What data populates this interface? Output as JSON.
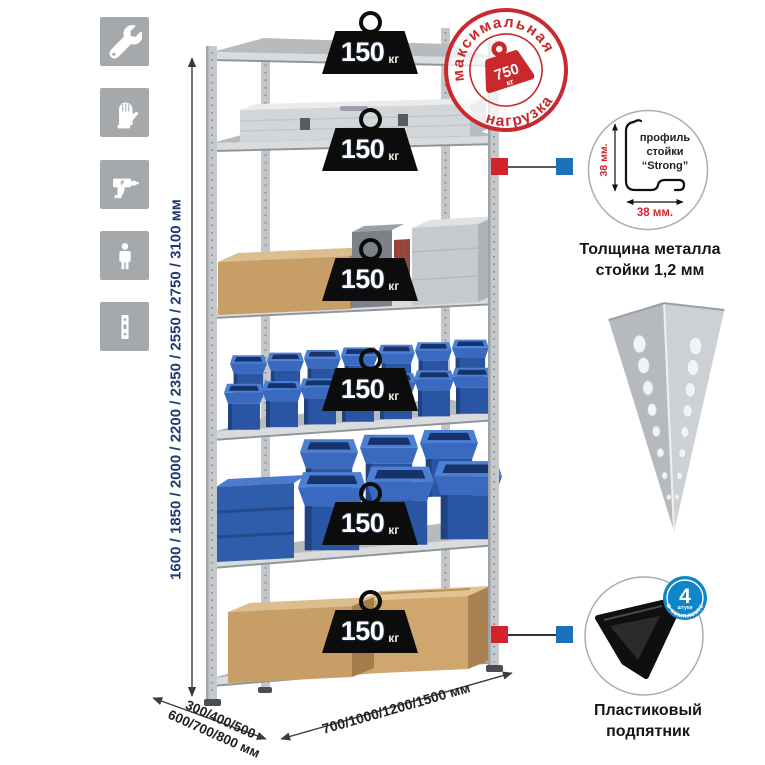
{
  "sidebar": {
    "icons": [
      {
        "name": "wrench-icon"
      },
      {
        "name": "gloves-icon"
      },
      {
        "name": "drill-icon"
      },
      {
        "name": "person-icon"
      },
      {
        "name": "rack-post-icon"
      }
    ]
  },
  "stamp": {
    "arc_top": "максимальная",
    "arc_bottom": "нагрузка",
    "value": "750",
    "unit": "кг"
  },
  "shelves": [
    {
      "load": "150",
      "unit": "кг"
    },
    {
      "load": "150",
      "unit": "кг"
    },
    {
      "load": "150",
      "unit": "кг"
    },
    {
      "load": "150",
      "unit": "кг"
    },
    {
      "load": "150",
      "unit": "кг"
    },
    {
      "load": "150",
      "unit": "кг"
    }
  ],
  "labels": {
    "height_options": "1600 / 1850 / 2000 / 2200 / 2350 / 2550 / 2750 / 3100 мм",
    "depth_options_1": "300/400/500",
    "depth_options_2": "600/700/800 мм",
    "width_options": "700/1000/1200/1500 мм"
  },
  "profile": {
    "text_line1": "профиль",
    "text_line2": "стойки",
    "text_line3": "“Strong”",
    "dim_vertical": "38 мм.",
    "dim_horizontal": "38 мм.",
    "caption_1": "Толщина металла",
    "caption_2": "стойки 1,2 мм"
  },
  "foot": {
    "badge_number": "4",
    "badge_small": "штуки",
    "badge_arc": "в комплекте",
    "caption_1": "Пластиковый",
    "caption_2": "подпятник"
  },
  "colors": {
    "stamp_red": "#c9292c",
    "marker_red": "#d2232a",
    "marker_blue": "#1d71b8",
    "dimension_text_blue": "#1f3b70",
    "bin_blue": "#2e5dad",
    "icon_gray": "#a6a9ac"
  }
}
